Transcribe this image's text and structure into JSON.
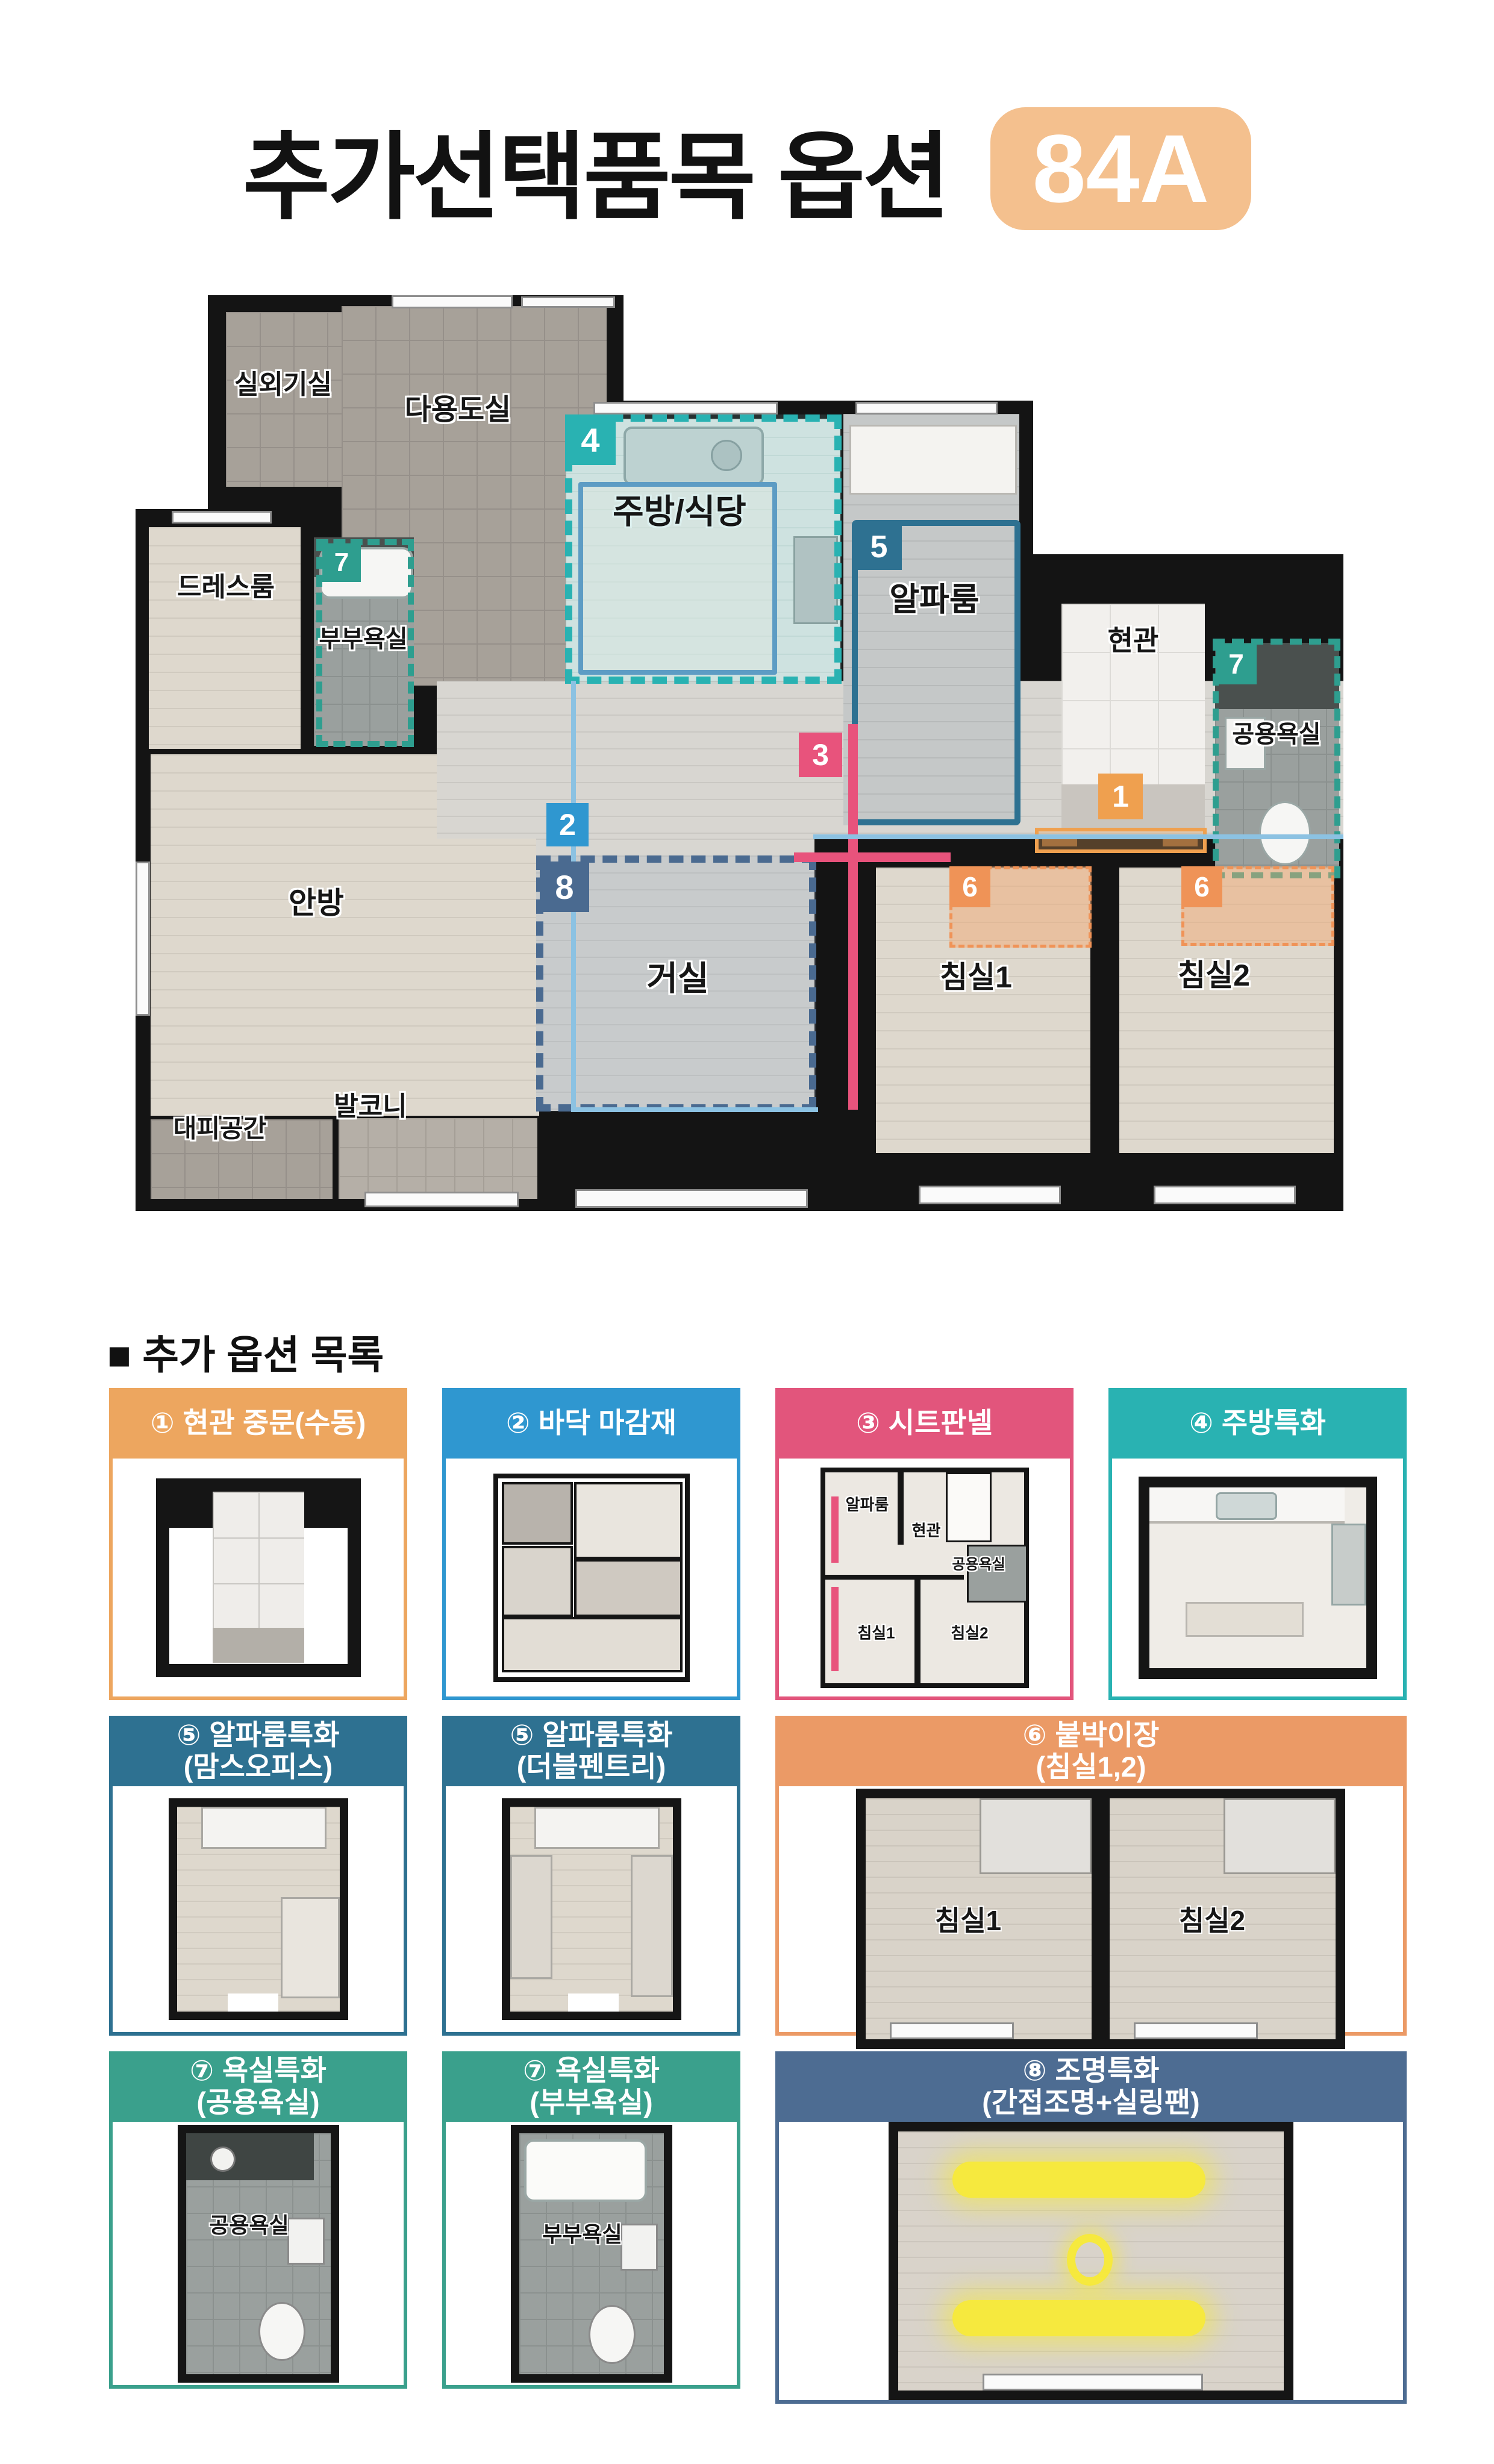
{
  "page": {
    "title": "추가선택품목 옵션",
    "badge": "84A"
  },
  "floorplan": {
    "rooms": {
      "outdoor_unit": "실외기실",
      "utility": "다용도실",
      "dressroom": "드레스룸",
      "master_bath": "부부욕실",
      "kitchen_dining": "주방/식당",
      "alpha_room": "알파룸",
      "entrance": "현관",
      "common_bath": "공용욕실",
      "master_bedroom": "안방",
      "living_room": "거실",
      "bedroom1": "침실1",
      "bedroom2": "침실2",
      "shelter": "대피공간",
      "balcony": "발코니"
    },
    "markers": {
      "m1": "1",
      "m2": "2",
      "m3": "3",
      "m4": "4",
      "m5": "5",
      "m6": "6",
      "m7": "7",
      "m8": "8"
    }
  },
  "options_section": {
    "heading": "■ 추가 옵션 목록",
    "cards": [
      {
        "num": "①",
        "title": "현관 중문(수동)",
        "subtitle": ""
      },
      {
        "num": "②",
        "title": "바닥 마감재",
        "subtitle": ""
      },
      {
        "num": "③",
        "title": "시트판넬",
        "subtitle": ""
      },
      {
        "num": "④",
        "title": "주방특화",
        "subtitle": ""
      },
      {
        "num": "⑤",
        "title": "알파룸특화",
        "subtitle": "(맘스오피스)"
      },
      {
        "num": "⑤",
        "title": "알파룸특화",
        "subtitle": "(더블펜트리)"
      },
      {
        "num": "⑥",
        "title": "붙박이장",
        "subtitle": "(침실1,2)"
      },
      {
        "num": "⑦",
        "title": "욕실특화",
        "subtitle": "(공용욕실)"
      },
      {
        "num": "⑦",
        "title": "욕실특화",
        "subtitle": "(부부욕실)"
      },
      {
        "num": "⑧",
        "title": "조명특화",
        "subtitle": "(간접조명+실링팬)"
      }
    ]
  },
  "colors": {
    "badge_bg": "#f4c08e",
    "option1_orange": "#eda65f",
    "option2_blue": "#2f97d0",
    "option3_pink": "#e2557c",
    "option4_teal": "#29b2b2",
    "option5_steel_blue": "#2e7191",
    "option6_orange": "#eb9a66",
    "option7_green_teal": "#3aa08c",
    "option8_slate_blue": "#4d6c92",
    "floor_line_blue": "#8cc2e2",
    "living_dash_navy": "#4a6a90",
    "lighting_yellow": "#f6e93e",
    "wall_black": "#141414"
  }
}
